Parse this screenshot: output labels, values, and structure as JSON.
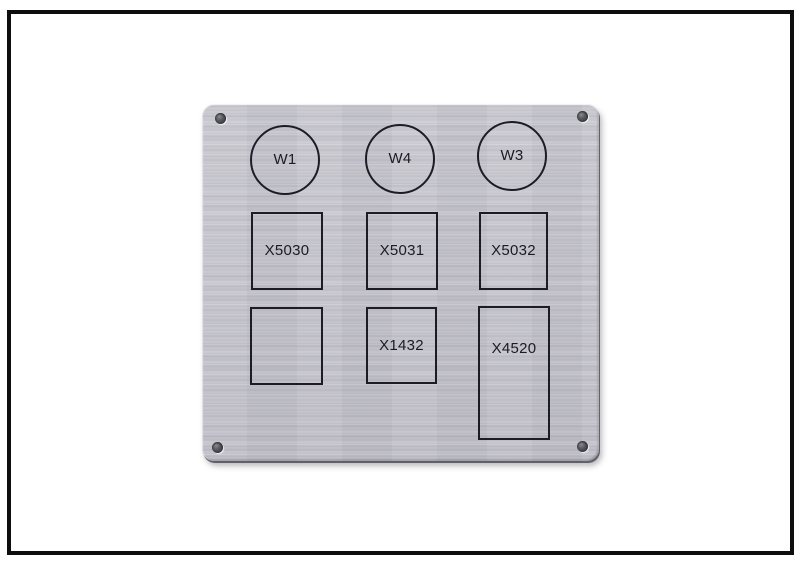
{
  "scene": {
    "colors": {
      "background": "#ffffff",
      "frame_border": "#0e0e0e",
      "plate_base": "#c2c1c9",
      "plate_streak_light": "#d2d1d9",
      "plate_streak_dark": "#b2b1bb",
      "engraving": "#1c1c26",
      "screw_hole": "#45454d",
      "plate_shadow": "#787880"
    },
    "plate": {
      "circle_markers": [
        {
          "label": "W1"
        },
        {
          "label": "W4"
        },
        {
          "label": "W3"
        }
      ],
      "row2_boxes": [
        {
          "label": "X5030"
        },
        {
          "label": "X5031"
        },
        {
          "label": "X5032"
        }
      ],
      "row3_boxes": [
        {
          "label": ""
        },
        {
          "label": "X1432"
        },
        {
          "label": "X4520"
        }
      ]
    }
  }
}
